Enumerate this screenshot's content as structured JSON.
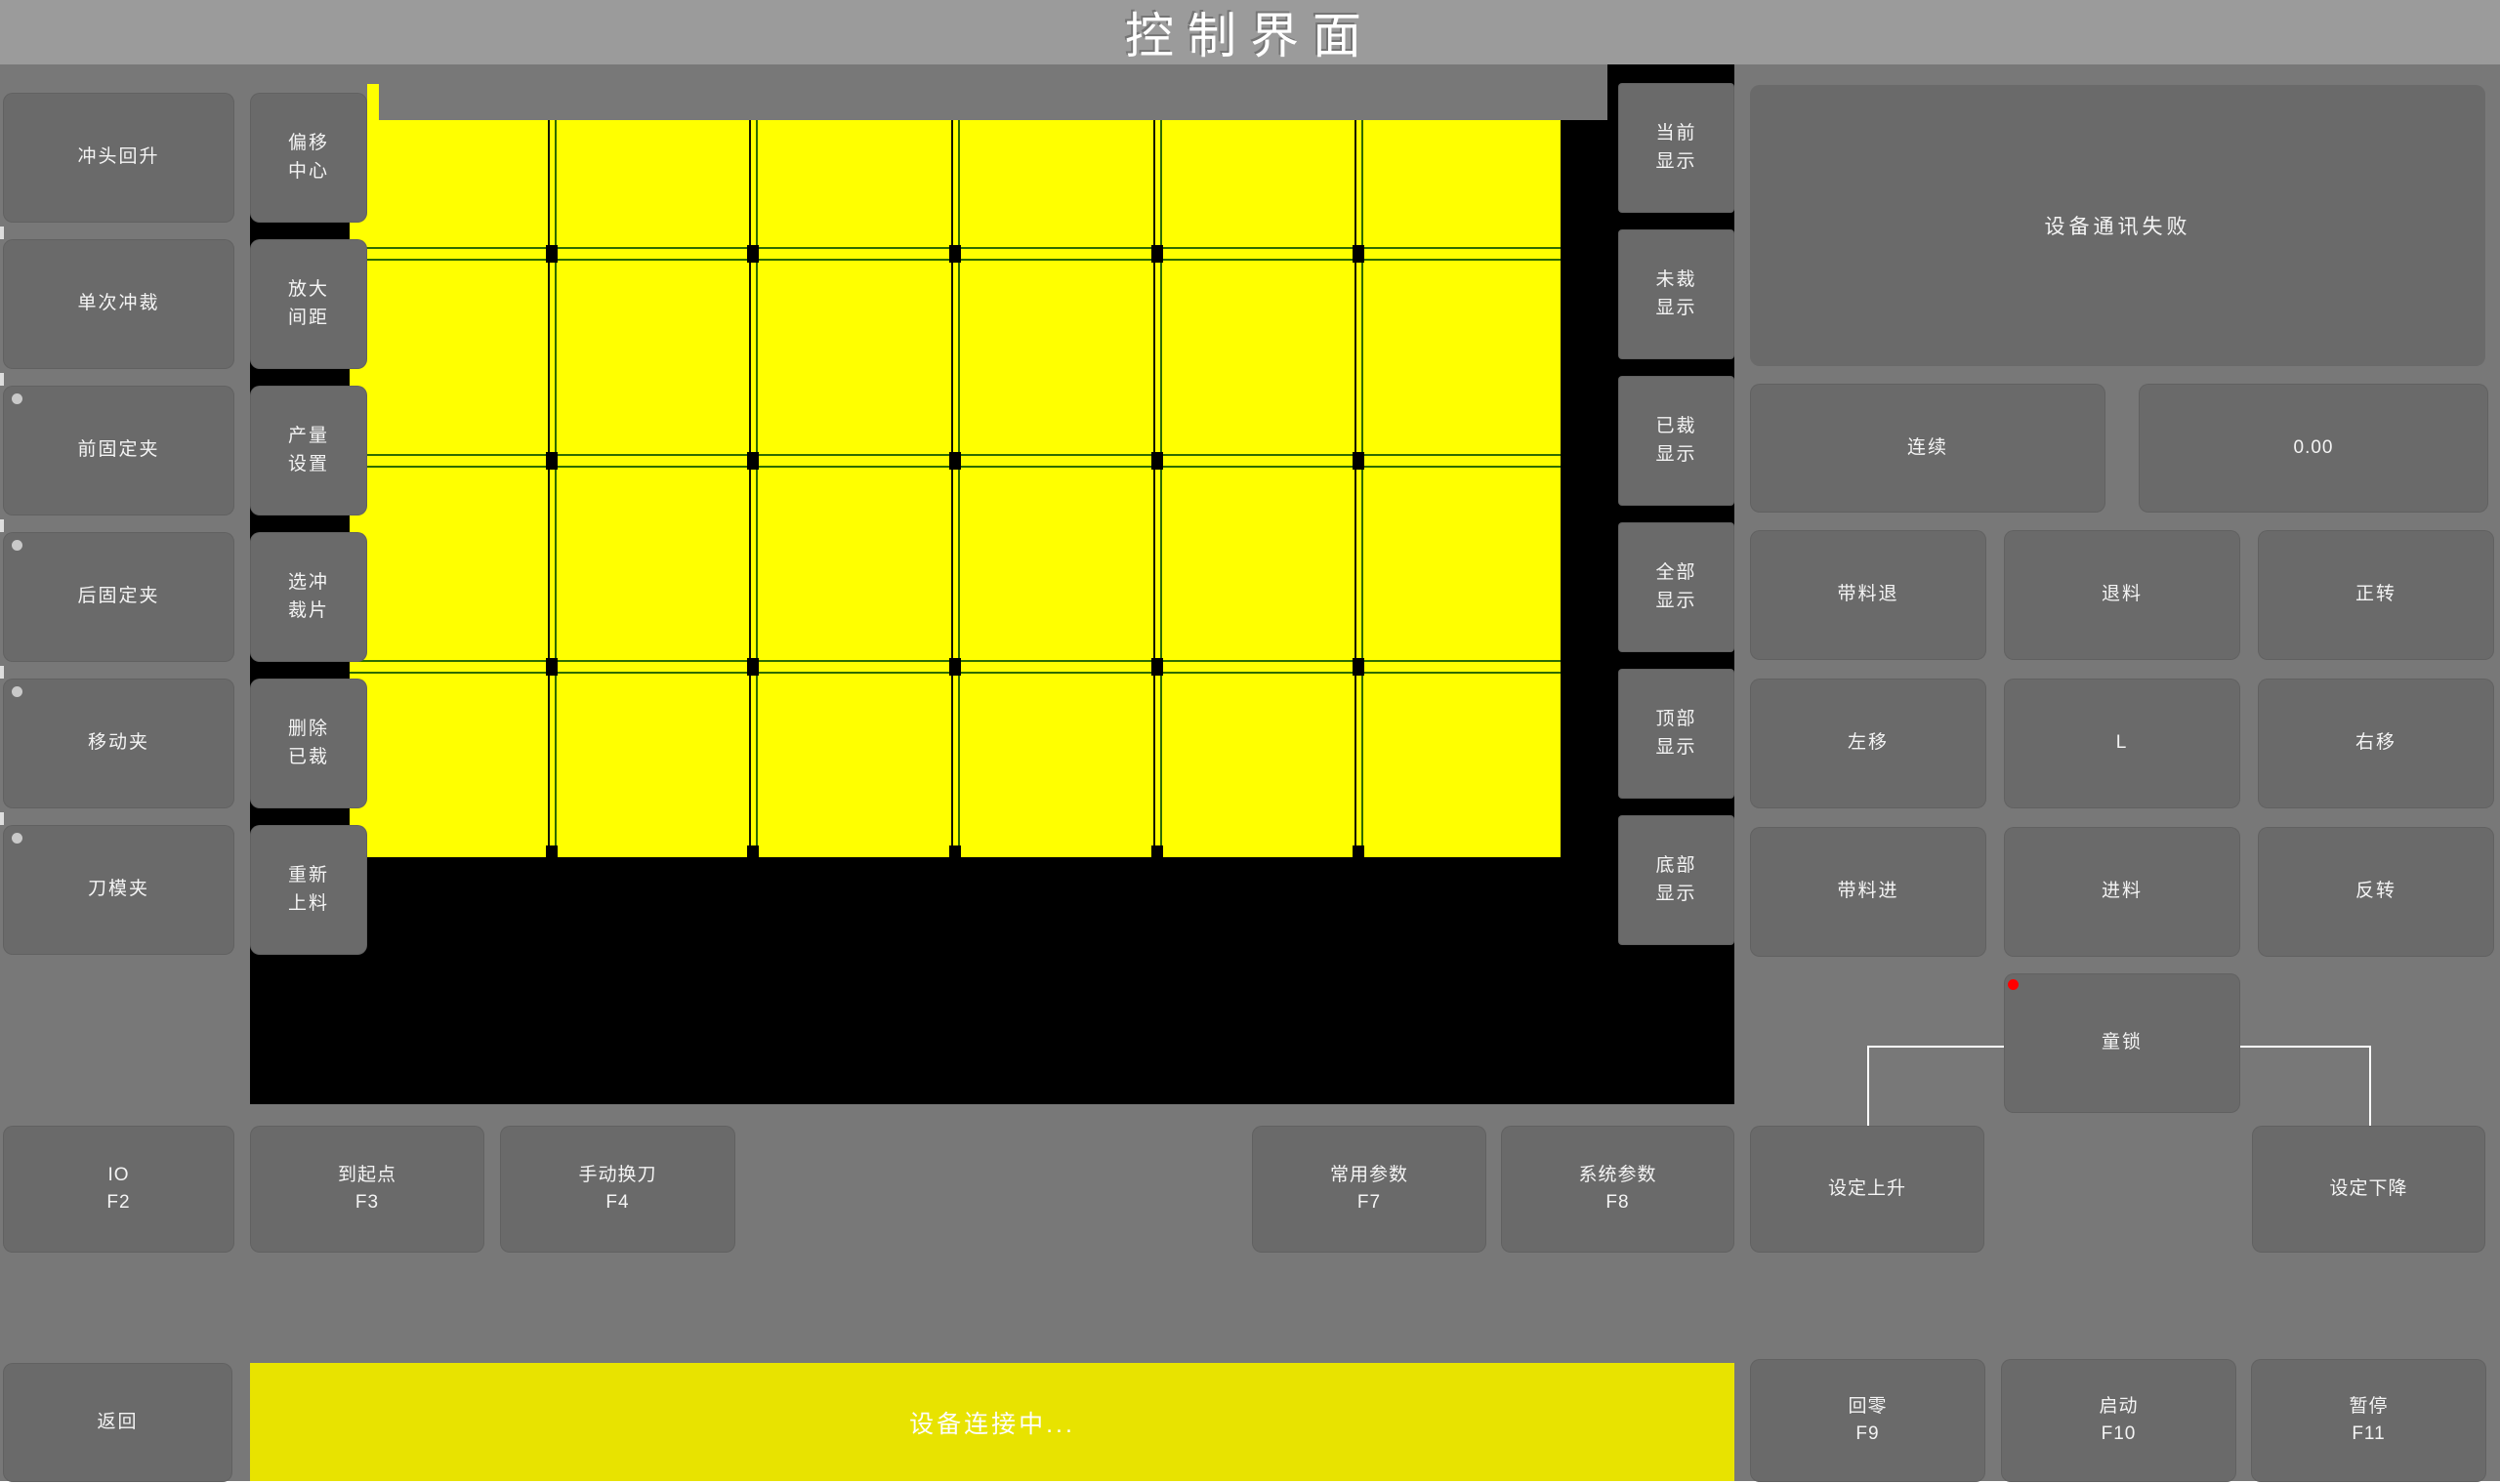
{
  "title": "控制界面",
  "left_column": {
    "items": [
      {
        "label": "冲头回升",
        "indicator": false
      },
      {
        "label": "单次冲裁",
        "indicator": false
      },
      {
        "label": "前固定夹",
        "indicator": true
      },
      {
        "label": "后固定夹",
        "indicator": true
      },
      {
        "label": "移动夹",
        "indicator": true
      },
      {
        "label": "刀模夹",
        "indicator": true
      }
    ]
  },
  "tool_column": {
    "items": [
      "偏移中心",
      "放大间距",
      "产量设置",
      "选冲裁片",
      "删除已裁",
      "重新上料"
    ]
  },
  "display_column": {
    "items": [
      "当前显示",
      "未裁显示",
      "已裁显示",
      "全部显示",
      "顶部显示",
      "底部显示"
    ]
  },
  "status_panel": {
    "message": "设备通讯失败"
  },
  "mode_row": {
    "mode_label": "连续",
    "value": "0.00"
  },
  "jog_grid": {
    "buttons": [
      "带料退",
      "退料",
      "正转",
      "左移",
      "L",
      "右移",
      "带料进",
      "进料",
      "反转"
    ]
  },
  "child_lock": {
    "label": "童锁",
    "indicator_icon": "red-alert-dot",
    "indicator_color": "#ff0000"
  },
  "function_row": [
    {
      "label": "IO",
      "fkey": "F2"
    },
    {
      "label": "到起点",
      "fkey": "F3"
    },
    {
      "label": "手动换刀",
      "fkey": "F4"
    },
    {
      "label": "常用参数",
      "fkey": "F7"
    },
    {
      "label": "系统参数",
      "fkey": "F8"
    },
    {
      "label": "设定上升",
      "fkey": ""
    },
    {
      "label": "设定下降",
      "fkey": ""
    }
  ],
  "bottom_bar": {
    "back": "返回",
    "status": "设备连接中...",
    "buttons": [
      {
        "label": "回零",
        "fkey": "F9"
      },
      {
        "label": "启动",
        "fkey": "F10"
      },
      {
        "label": "暂停",
        "fkey": "F11"
      }
    ]
  },
  "canvas": {
    "sheet_cols": 6,
    "sheet_rows": 4
  },
  "colors": {
    "sheet_yellow": "#ffff00",
    "status_bar_yellow": "#e8e300",
    "alert_red": "#ff0000",
    "cut_line_green": "#2e6b00",
    "canvas_black": "#000000"
  }
}
